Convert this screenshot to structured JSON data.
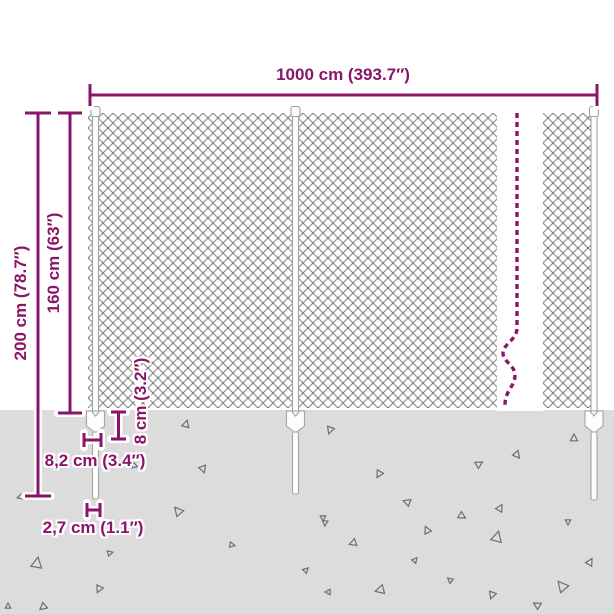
{
  "title": "Chain-link fence dimension diagram",
  "labels": {
    "width_total": "1000 cm (393.7″)",
    "height_total": "200 cm (78.7″)",
    "height_fence": "160 cm (63″)",
    "anchor_height": "8 cm (3.2″)",
    "anchor_width": "8,2 cm (3.4″)",
    "spike_width": "2,7 cm (1.1″)"
  },
  "colors": {
    "accent": "#8a1568",
    "bg": "#ffffff",
    "ground": "#dcdcdc",
    "mesh": "#9b9b9b",
    "mesh_knot": "#767676",
    "post_fill": "#fdfdfd",
    "post_stroke": "#a3a3a3",
    "triangle": "#6e6e6e"
  },
  "ground": {
    "triangles": [
      {
        "x": 186,
        "y": 424,
        "s": 4,
        "r": 15
      },
      {
        "x": 330,
        "y": 430,
        "s": 4,
        "r": 200
      },
      {
        "x": 574,
        "y": 438,
        "s": 4,
        "r": 0
      },
      {
        "x": 203,
        "y": 469,
        "s": 4,
        "r": 160
      },
      {
        "x": 134,
        "y": 466,
        "s": 3,
        "r": 230
      },
      {
        "x": 178,
        "y": 511,
        "s": 5,
        "r": 320
      },
      {
        "x": 20,
        "y": 497,
        "s": 3,
        "r": 255
      },
      {
        "x": 517,
        "y": 455,
        "s": 4,
        "r": 140
      },
      {
        "x": 479,
        "y": 464,
        "s": 4,
        "r": 60
      },
      {
        "x": 379,
        "y": 474,
        "s": 4,
        "r": 210
      },
      {
        "x": 407,
        "y": 502,
        "s": 4,
        "r": 290
      },
      {
        "x": 462,
        "y": 516,
        "s": 4,
        "r": 120
      },
      {
        "x": 500,
        "y": 508,
        "s": 4,
        "r": 30
      },
      {
        "x": 323,
        "y": 518,
        "s": 3,
        "r": 180
      },
      {
        "x": 37,
        "y": 563,
        "s": 6,
        "r": 10
      },
      {
        "x": 99,
        "y": 589,
        "s": 4,
        "r": 205
      },
      {
        "x": 43,
        "y": 607,
        "s": 4,
        "r": 230
      },
      {
        "x": 8,
        "y": 606,
        "s": 3,
        "r": 0
      },
      {
        "x": 110,
        "y": 553,
        "s": 3,
        "r": 75
      },
      {
        "x": 325,
        "y": 523,
        "s": 3,
        "r": 185
      },
      {
        "x": 353,
        "y": 543,
        "s": 4,
        "r": 250
      },
      {
        "x": 427,
        "y": 530,
        "s": 4,
        "r": 335
      },
      {
        "x": 415,
        "y": 560,
        "s": 3,
        "r": 40
      },
      {
        "x": 497,
        "y": 537,
        "s": 6,
        "r": 15
      },
      {
        "x": 568,
        "y": 522,
        "s": 3,
        "r": 180
      },
      {
        "x": 590,
        "y": 562,
        "s": 4,
        "r": 30
      },
      {
        "x": 562,
        "y": 586,
        "s": 6,
        "r": 320
      },
      {
        "x": 492,
        "y": 595,
        "s": 4,
        "r": 200
      },
      {
        "x": 537,
        "y": 605,
        "s": 4,
        "r": 300
      },
      {
        "x": 380,
        "y": 590,
        "s": 5,
        "r": 255
      },
      {
        "x": 328,
        "y": 592,
        "s": 3,
        "r": 270
      },
      {
        "x": 306,
        "y": 570,
        "s": 3,
        "r": 45
      },
      {
        "x": 450,
        "y": 580,
        "s": 3,
        "r": 310
      },
      {
        "x": 232,
        "y": 545,
        "s": 3,
        "r": 100
      }
    ]
  }
}
